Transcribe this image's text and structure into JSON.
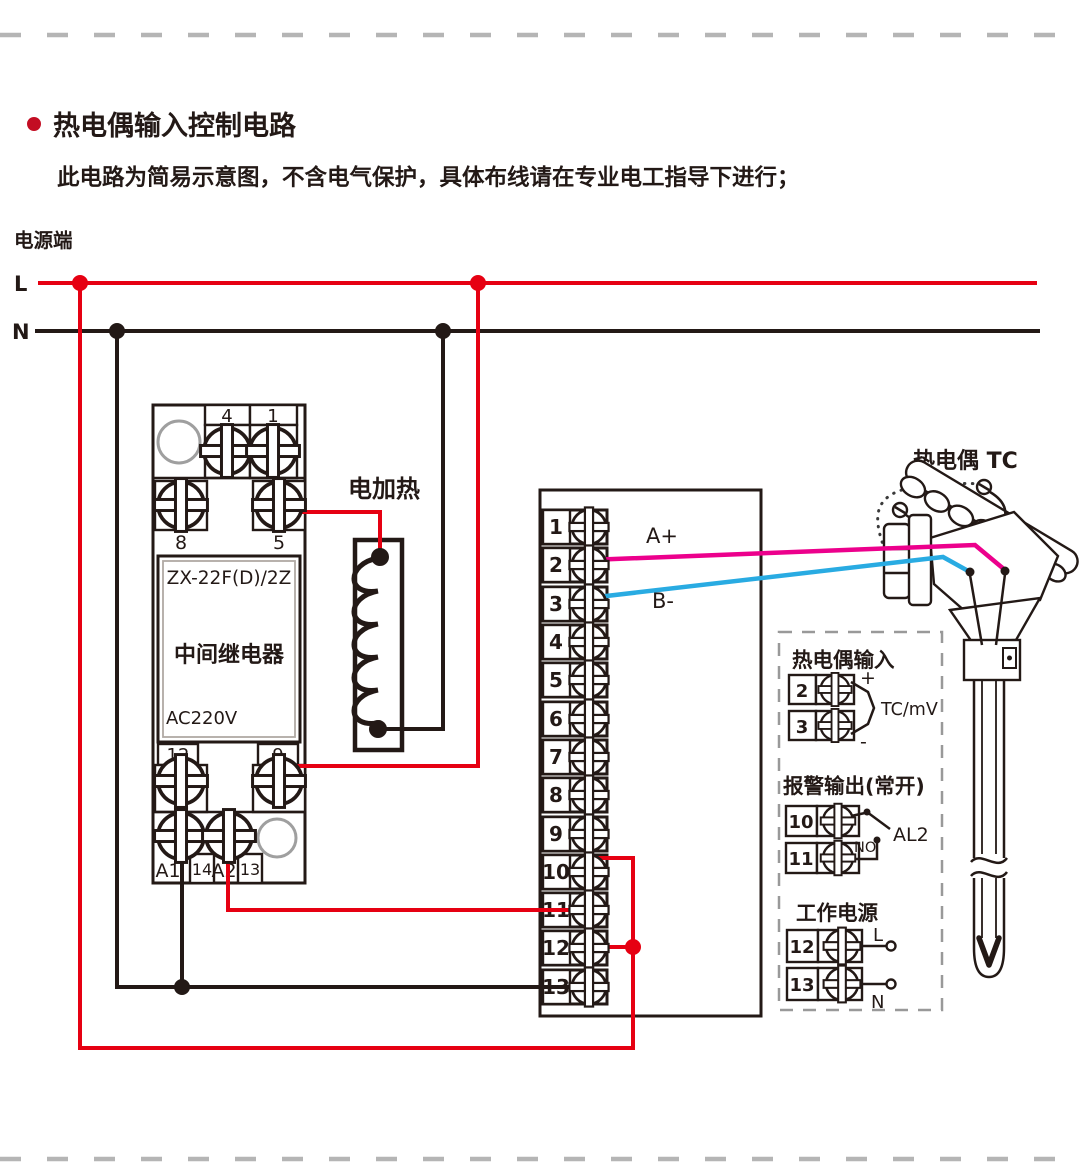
{
  "page": {
    "title": "热电偶输入控制电路",
    "subtitle": "此电路为简易示意图，不含电气保护，具体布线请在专业电工指导下进行；"
  },
  "power": {
    "label": "电源端",
    "l": "L",
    "n": "N"
  },
  "relay": {
    "model": "ZX-22F(D)/2Z",
    "name": "中间继电器",
    "voltage": "AC220V",
    "terminals": {
      "t4": "4",
      "t1": "1",
      "t8": "8",
      "t5": "5",
      "t12": "12",
      "t9": "9",
      "a1": "A1",
      "t14": "14",
      "a2": "A2",
      "t13": "13"
    }
  },
  "heater": {
    "label": "电加热"
  },
  "terminal_block": {
    "terminals": [
      "1",
      "2",
      "3",
      "4",
      "5",
      "6",
      "7",
      "8",
      "9",
      "10",
      "11",
      "12",
      "13"
    ]
  },
  "wires": {
    "a_plus": "A+",
    "b_minus": "B-"
  },
  "thermocouple": {
    "label": "热电偶 TC"
  },
  "panel": {
    "tc_input": {
      "title": "热电偶输入",
      "t2": "2",
      "t3": "3",
      "plus": "+",
      "minus": "-",
      "signal": "TC/mV"
    },
    "alarm": {
      "title": "报警输出(常开)",
      "t10": "10",
      "t11": "11",
      "no": "NO",
      "al2": "AL2"
    },
    "power": {
      "title": "工作电源",
      "t12": "12",
      "t13": "13",
      "l": "L",
      "n": "N"
    }
  },
  "colors": {
    "live": "#e60012",
    "neutral": "#231916",
    "signal_a": "#ec008c",
    "signal_b": "#29abe2",
    "bullet": "#c30d23",
    "border_gray": "#b5b5b5",
    "panel_dash": "#999999"
  }
}
